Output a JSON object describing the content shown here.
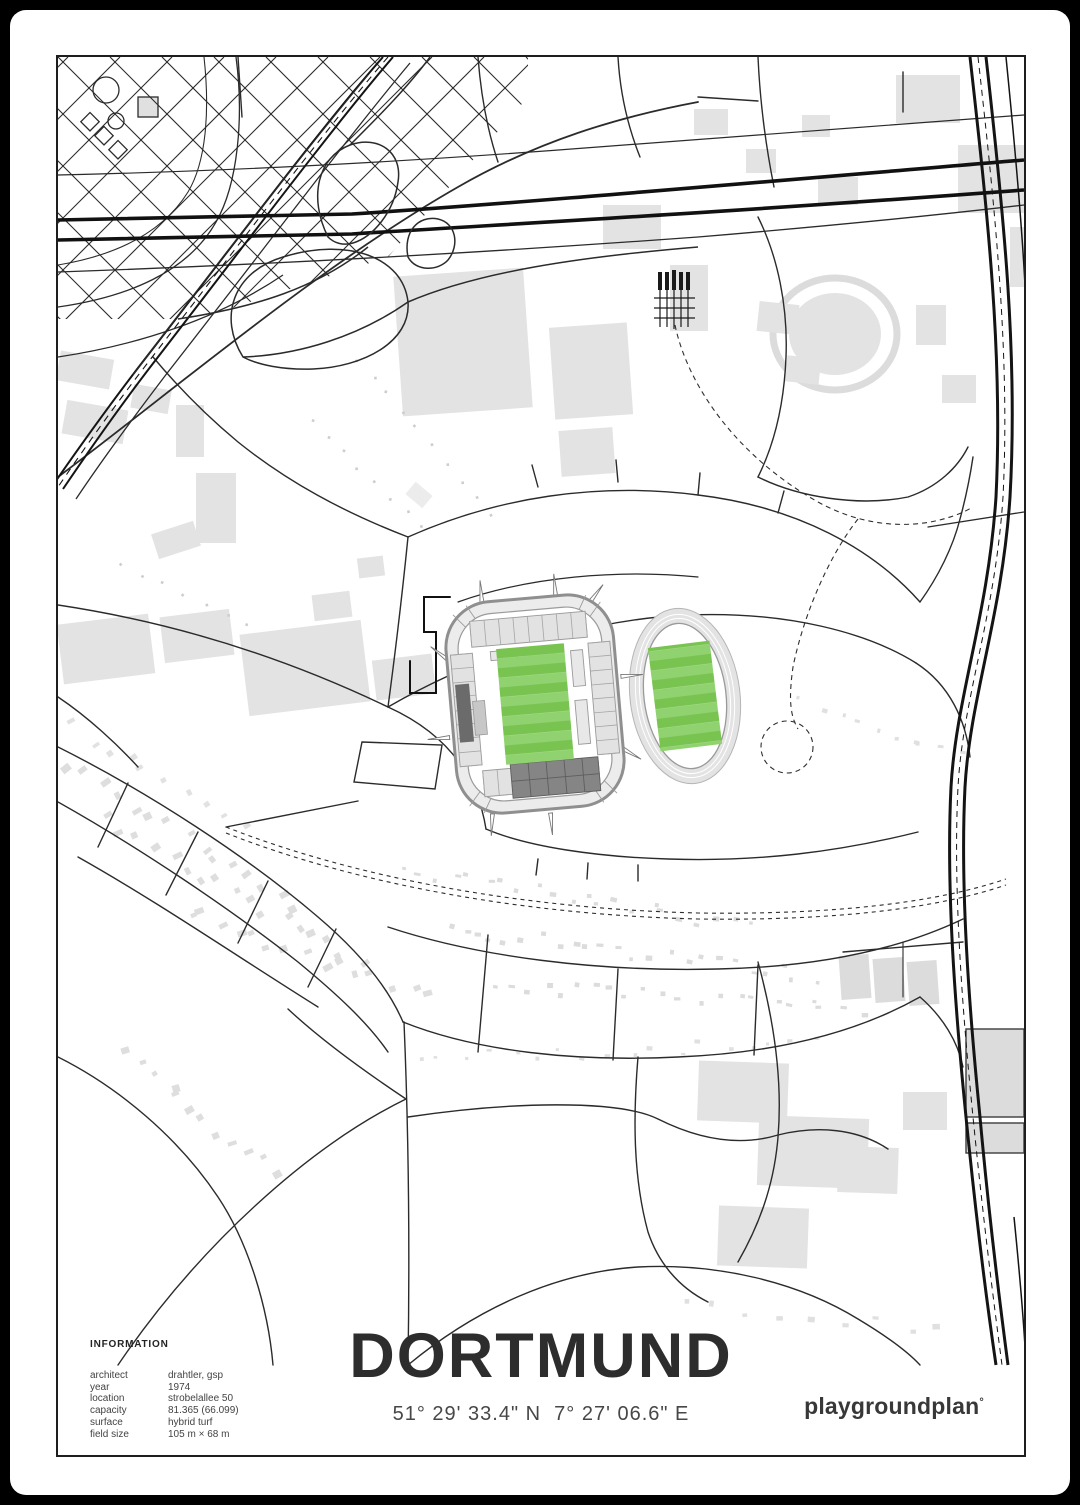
{
  "poster": {
    "title": "DORTMUND",
    "coordinates": "51° 29' 33.4\" N  7° 27' 06.6\" E",
    "brand": "playgroundplan",
    "brand_mark": "°",
    "info": {
      "heading": "INFORMATION",
      "rows": [
        {
          "label": "architect",
          "value": "drahtler, gsp"
        },
        {
          "label": "year",
          "value": "1974"
        },
        {
          "label": "location",
          "value": "strobelallee 50"
        },
        {
          "label": "capacity",
          "value": "81.365 (66.099)"
        },
        {
          "label": "surface",
          "value": "hybrid turf"
        },
        {
          "label": "field size",
          "value": "105 m × 68 m"
        }
      ]
    },
    "map": {
      "subject": "stadium district map of Dortmund (Signal Iduna Park with athletics stadium)",
      "colors": {
        "pitch_green_dark": "#79c450",
        "pitch_green_light": "#90d170",
        "building_gray": "#e3e3e3",
        "road_line": "#2b2b2b",
        "rail_line": "#141414",
        "stand_dark": "#6b6b6b",
        "stand_south_dark": "#858585",
        "frame_border": "#1e1e1e"
      }
    }
  }
}
